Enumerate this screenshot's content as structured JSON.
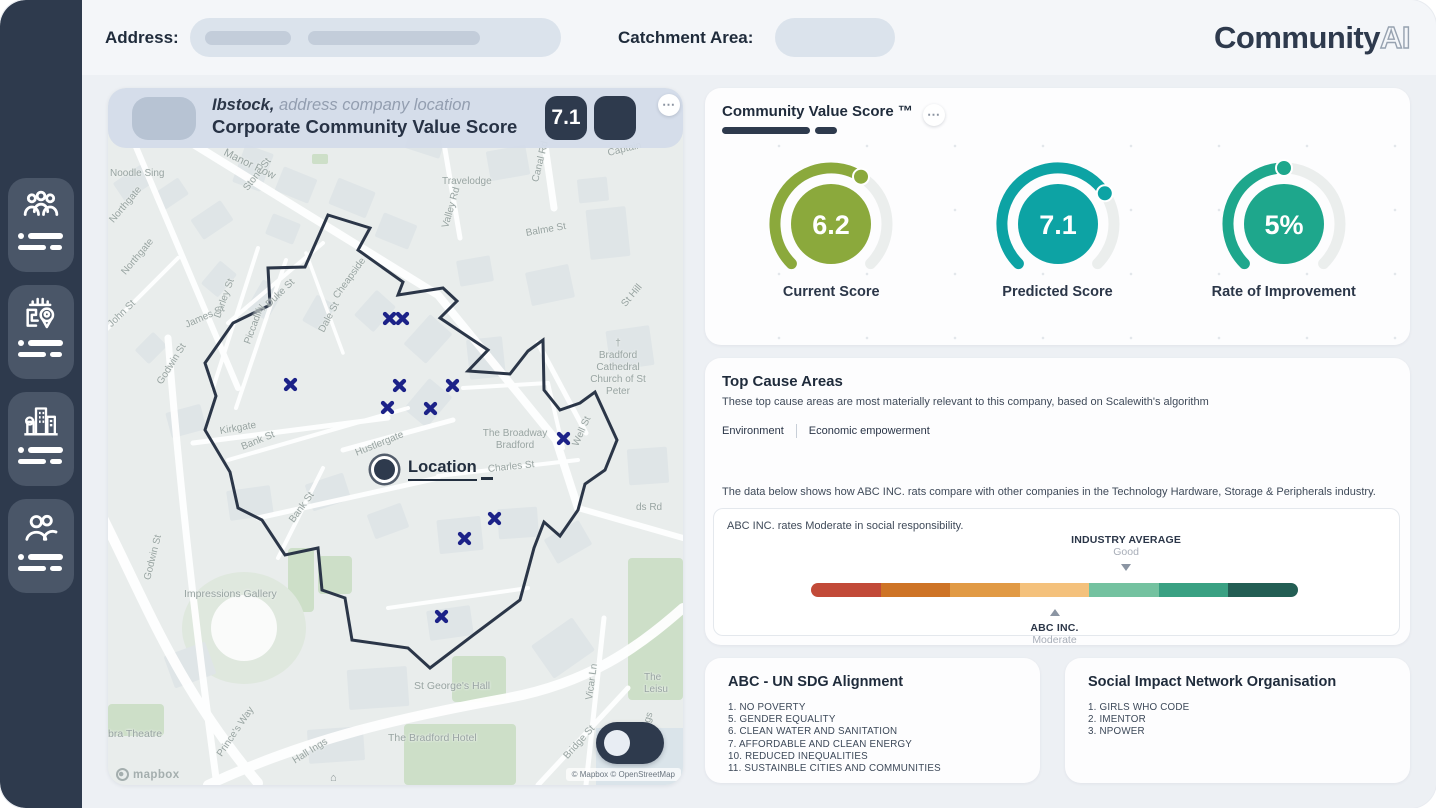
{
  "topbar": {
    "address_label": "Address:",
    "catchment_label": "Catchment Area:",
    "logo_main": "Community",
    "logo_accent": "AI"
  },
  "sidebar": {
    "items": [
      {
        "icon": "people-group"
      },
      {
        "icon": "map-location"
      },
      {
        "icon": "city-buildings"
      },
      {
        "icon": "team"
      }
    ]
  },
  "map": {
    "header": {
      "company": "Ibstock,",
      "tagline": "address company location",
      "title": "Corporate Community Value Score",
      "score": "7.1",
      "menu": "⋯"
    },
    "location_label": "Location",
    "mapbox_logo": "mapbox",
    "attribution": "© Mapbox © OpenStreetMap",
    "markers": [
      [
        281,
        230
      ],
      [
        294,
        230
      ],
      [
        182,
        296
      ],
      [
        291,
        297
      ],
      [
        344,
        297
      ],
      [
        279,
        319
      ],
      [
        322,
        320
      ],
      [
        455,
        350
      ],
      [
        386,
        430
      ],
      [
        356,
        450
      ],
      [
        333,
        528
      ]
    ],
    "location": {
      "x": 275,
      "y": 380
    },
    "marker_color": "#1c2288",
    "labels": [
      {
        "t": "Noodle Sing",
        "x": 2,
        "y": 80,
        "s": 10
      },
      {
        "t": "Manor Row",
        "x": 116,
        "y": 58,
        "r": 26,
        "s": 11
      },
      {
        "t": "Stone St",
        "x": 138,
        "y": 96,
        "r": -52,
        "s": 10
      },
      {
        "t": "Travelodge",
        "x": 334,
        "y": 88,
        "s": 10
      },
      {
        "t": "Valley Rd",
        "x": 338,
        "y": 134,
        "r": -74,
        "s": 10
      },
      {
        "t": "Balme St",
        "x": 418,
        "y": 140,
        "r": -10,
        "s": 10
      },
      {
        "t": "Canal Rd",
        "x": 428,
        "y": 88,
        "r": -76,
        "s": 10
      },
      {
        "t": "Captain",
        "x": 500,
        "y": 60,
        "r": -14,
        "s": 10
      },
      {
        "t": "Northgate",
        "x": 4,
        "y": 128,
        "r": -50,
        "s": 10
      },
      {
        "t": "Northgate",
        "x": 16,
        "y": 180,
        "r": -50,
        "s": 10
      },
      {
        "t": "John St",
        "x": 2,
        "y": 232,
        "r": -44,
        "s": 10
      },
      {
        "t": "Duke St",
        "x": 160,
        "y": 212,
        "r": -44,
        "s": 10
      },
      {
        "t": "Dale St",
        "x": 214,
        "y": 238,
        "r": -62,
        "s": 10
      },
      {
        "t": "Cheapside",
        "x": 228,
        "y": 204,
        "r": -54,
        "s": 10
      },
      {
        "t": "Darley St",
        "x": 110,
        "y": 224,
        "r": -70,
        "s": 10
      },
      {
        "t": "Piccadilly",
        "x": 140,
        "y": 250,
        "r": -70,
        "s": 10
      },
      {
        "t": "James St",
        "x": 78,
        "y": 232,
        "r": -24,
        "s": 10
      },
      {
        "t": "Godwin St",
        "x": 52,
        "y": 290,
        "r": -58,
        "s": 10
      },
      {
        "t": "Godwin St",
        "x": 40,
        "y": 486,
        "r": -76,
        "s": 10
      },
      {
        "t": "Kirkgate",
        "x": 112,
        "y": 338,
        "r": -10,
        "s": 10
      },
      {
        "t": "Bank St",
        "x": 134,
        "y": 354,
        "r": -22,
        "s": 10
      },
      {
        "t": "Bank St",
        "x": 184,
        "y": 428,
        "r": -54,
        "s": 10
      },
      {
        "t": "Hustlergate",
        "x": 248,
        "y": 360,
        "r": -22,
        "s": 10
      },
      {
        "t": "The Broadway\nBradford",
        "x": 407,
        "y": 340,
        "s": 10,
        "c": 1
      },
      {
        "t": "Charles St",
        "x": 380,
        "y": 376,
        "r": -6,
        "s": 10
      },
      {
        "t": "†\nBradford Cathedral\nChurch of St Peter",
        "x": 510,
        "y": 250,
        "s": 10,
        "c": 1
      },
      {
        "t": "Well St",
        "x": 468,
        "y": 352,
        "r": -66,
        "s": 10
      },
      {
        "t": "St Hill",
        "x": 516,
        "y": 212,
        "r": -50,
        "s": 10
      },
      {
        "t": "ds Rd",
        "x": 528,
        "y": 414,
        "s": 10
      },
      {
        "t": "Impressions Gallery",
        "x": 76,
        "y": 500,
        "s": 10.5
      },
      {
        "t": "St George's Hall",
        "x": 306,
        "y": 592,
        "s": 10.5
      },
      {
        "t": "The Bradford Hotel",
        "x": 280,
        "y": 644,
        "s": 10.5
      },
      {
        "t": "bra Theatre",
        "x": 0,
        "y": 640,
        "s": 10.5
      },
      {
        "t": "Prince's Way",
        "x": 112,
        "y": 662,
        "r": -56,
        "s": 10
      },
      {
        "t": "Hall Ings",
        "x": 186,
        "y": 668,
        "r": -32,
        "s": 10
      },
      {
        "t": "Hall Ings",
        "x": 532,
        "y": 656,
        "r": -74,
        "s": 10
      },
      {
        "t": "Bridge St",
        "x": 458,
        "y": 664,
        "r": -48,
        "s": 10
      },
      {
        "t": "Vicar Ln",
        "x": 482,
        "y": 606,
        "r": -82,
        "s": 10
      },
      {
        "t": "The Leisu",
        "x": 536,
        "y": 584,
        "s": 10
      }
    ]
  },
  "score_card": {
    "title": "Community Value Score ™",
    "menu": "⋯",
    "gauges": [
      {
        "value": "6.2",
        "fraction": 0.62,
        "label": "Current Score",
        "color": "#8BA93C"
      },
      {
        "value": "7.1",
        "fraction": 0.71,
        "label": "Predicted Score",
        "color": "#0DA3A4"
      },
      {
        "value": "5%",
        "fraction": 0.5,
        "label": "Rate of Improvement",
        "color": "#1EA78C"
      }
    ]
  },
  "cause_card": {
    "title": "Top Cause Areas",
    "subtitle": "These top cause areas are most materially relevant to this company, based on Scalewith's algorithm",
    "tags": [
      "Environment",
      "Economic empowerment"
    ],
    "comparison_intro": "The data below shows how ABC INC. rats compare with other companies in the Technology Hardware, Storage & Peripherals industry.",
    "rating_line": "ABC INC. rates Moderate in social responsibility.",
    "scale": {
      "segments": [
        "#C24A38",
        "#CE7426",
        "#E19A45",
        "#F4C17C",
        "#74C2A0",
        "#3AA183",
        "#235E54"
      ],
      "industry": {
        "label": "INDUSTRY AVERAGE",
        "value": "Good",
        "position": 64.7
      },
      "company": {
        "label": "ABC INC.",
        "value": "Moderate",
        "position": 50
      }
    }
  },
  "sdg_card": {
    "title": "ABC - UN SDG Alignment",
    "items": [
      "1. NO POVERTY",
      "5. GENDER EQUALITY",
      "6. CLEAN WATER AND SANITATION",
      "7. AFFORDABLE AND CLEAN ENERGY",
      "10. REDUCED INEQUALITIES",
      "11. SUSTAINBLE CITIES AND COMMUNITIES"
    ]
  },
  "impact_card": {
    "title": "Social Impact Network Organisation",
    "items": [
      "1. GIRLS WHO CODE",
      "2. IMENTOR",
      "3. NPOWER"
    ]
  }
}
